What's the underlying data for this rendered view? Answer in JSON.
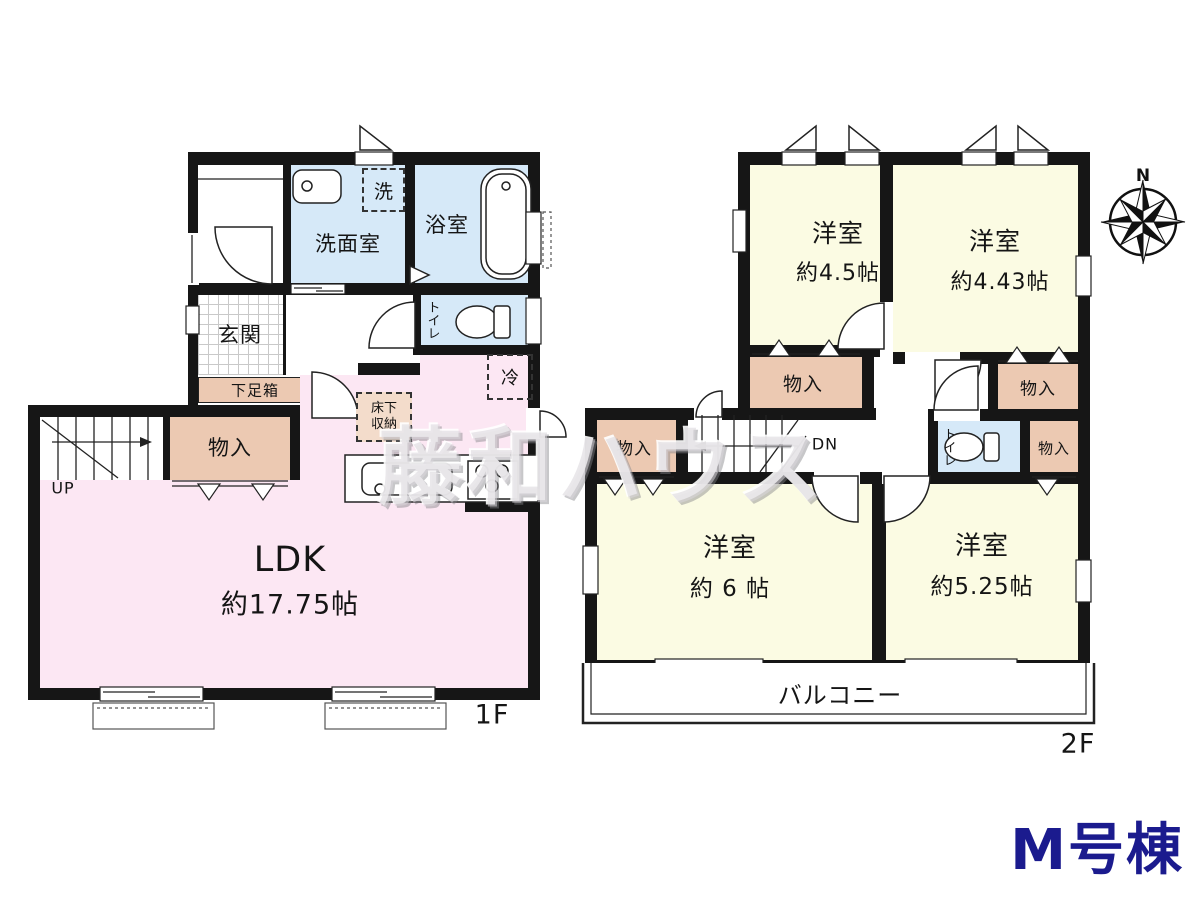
{
  "building_label": "M号棟",
  "watermark": "藤和ハウス",
  "compass": {
    "north_label": "N"
  },
  "colors": {
    "room_pink": "#fce7f3",
    "room_cream": "#fbfbe3",
    "room_blue": "#d6e9f8",
    "storage_tan": "#ecc9b2",
    "wall": "#161616",
    "building_label_navy": "#1b1b8e"
  },
  "floor1": {
    "floor_label": "1F",
    "ldk": {
      "name": "LDK",
      "size": "約17.75帖"
    },
    "entrance": "玄関",
    "washroom": "洗面室",
    "bathroom": "浴室",
    "laundry": "洗",
    "toilet": "トイレ",
    "shoe_box": "下足箱",
    "storage": "物入",
    "fridge": "冷",
    "underfloor_storage": "床下収納",
    "stairs_up": "UP"
  },
  "floor2": {
    "floor_label": "2F",
    "rooms": [
      {
        "name": "洋室",
        "size": "約4.5帖"
      },
      {
        "name": "洋室",
        "size": "約4.43帖"
      },
      {
        "name": "洋室",
        "size": "約 6 帖"
      },
      {
        "name": "洋室",
        "size": "約5.25帖"
      }
    ],
    "storage": "物入",
    "toilet": "トイレ",
    "stairs_down": "DN",
    "balcony": "バルコニー"
  }
}
